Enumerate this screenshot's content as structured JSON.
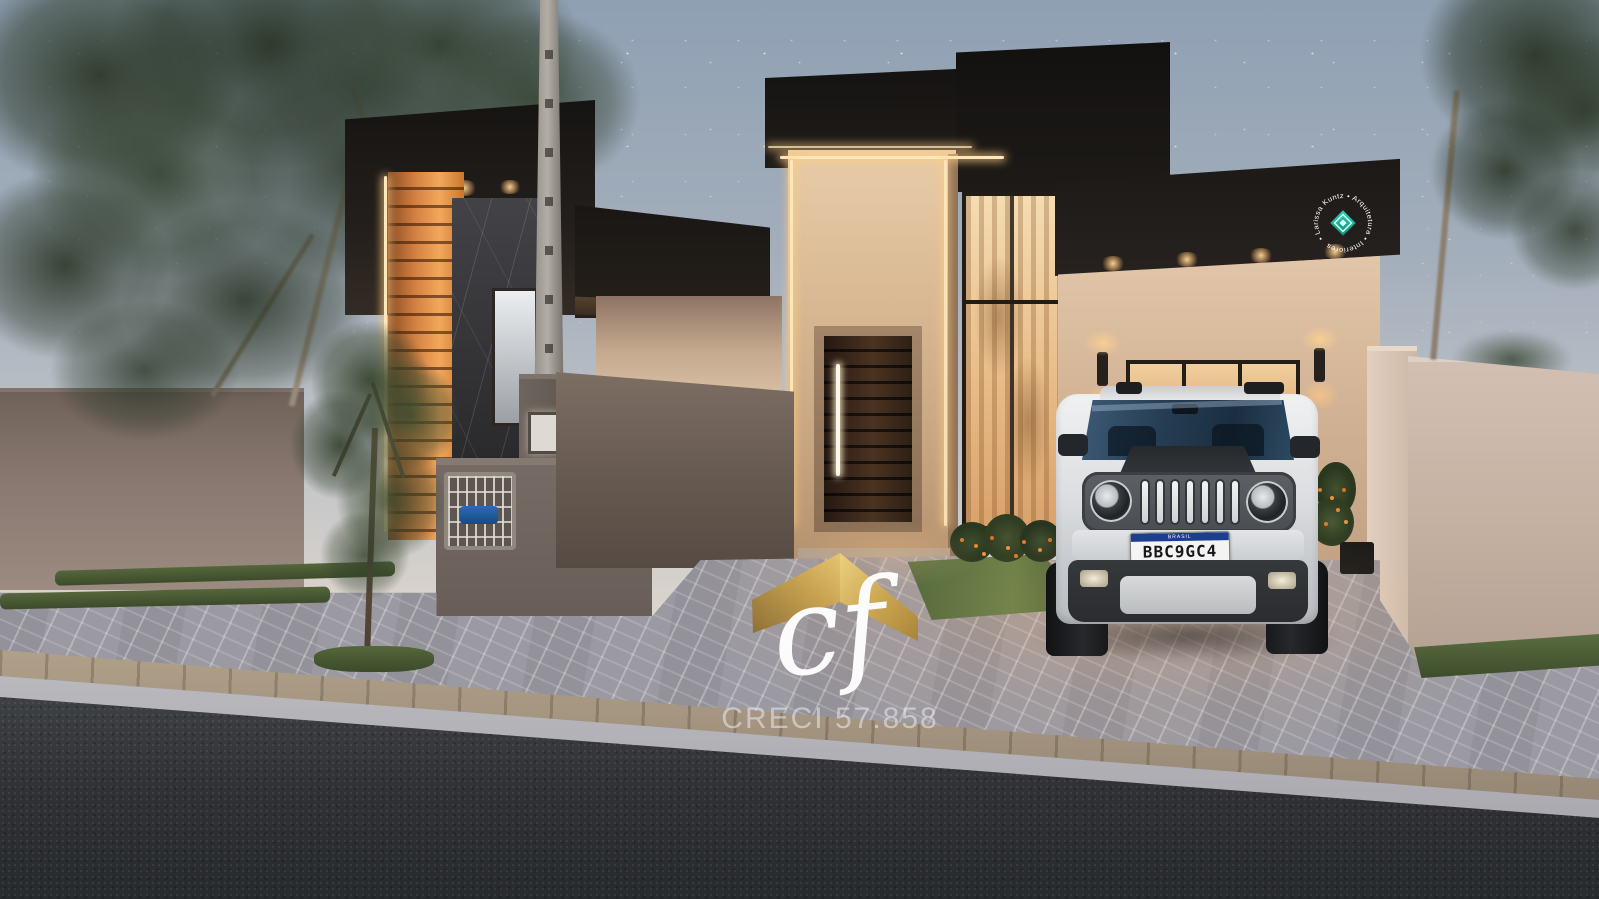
{
  "scene": {
    "type": "architectural-render",
    "subject": "modern single-story houses at dusk with paver driveway, street, trees and parked SUV"
  },
  "watermark": {
    "initials": "cf",
    "registration": "CRECI 57.858",
    "roof_icon": "gold-roof-chevron",
    "gold_dark": "#8f6f33",
    "gold_mid": "#c9a34f",
    "gold_light": "#e8c76f"
  },
  "stamp": {
    "circular_text": "• Larissa Kuntz • Arquitetura • Interiores",
    "icon": "teal-diamond",
    "icon_color": "#17a289",
    "text_color": "#ffffff"
  },
  "vehicle": {
    "type": "white SUV, front view",
    "license_plate": {
      "header": "BRASIL",
      "number": "BBC9GC4",
      "stripe_color": "#1c3e8e",
      "plate_bg": "#f4f4f2"
    }
  },
  "palette": {
    "sky_top": "#8fa0b3",
    "sky_horizon": "#f0e3d6",
    "dark_volume": "#1c1917",
    "wood_accent": "#d27f40",
    "stucco": "#d6b896",
    "perimeter_wall": "#83746c",
    "paver": "#9b99a1",
    "asphalt": "#35373a",
    "grass": "#4e5f38",
    "led_warm": "#ffe7bb"
  }
}
